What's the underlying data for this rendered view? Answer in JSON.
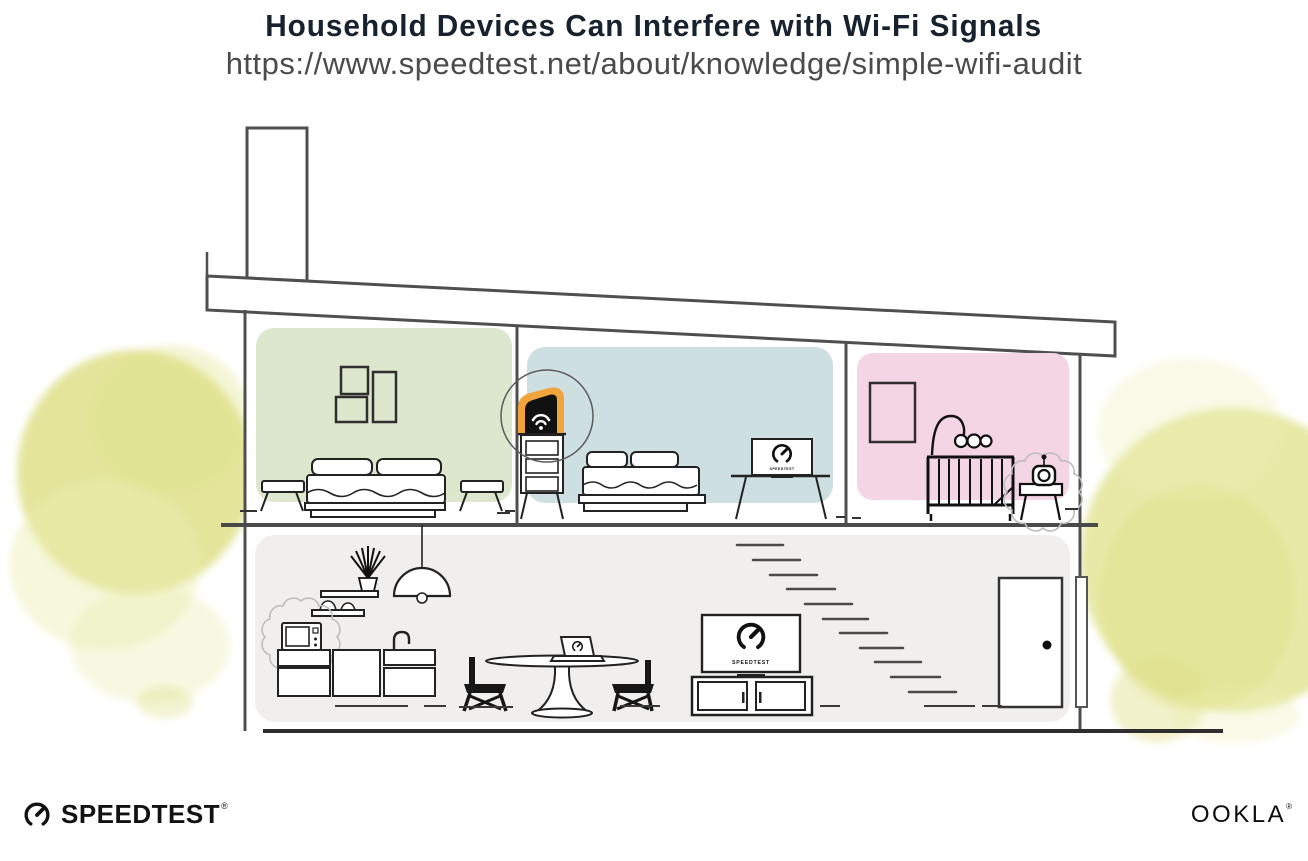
{
  "header": {
    "title": "Household Devices Can Interfere with Wi-Fi Signals",
    "url": "https://www.speedtest.net/about/knowledge/simple-wifi-audit"
  },
  "device_screens": {
    "tv_brand": "SPEEDTEST",
    "monitor_brand": "SPEEDTEST"
  },
  "footer": {
    "speedtest_wordmark": "SPEEDTEST",
    "speedtest_reg": "®",
    "ookla_wordmark": "OOKLA",
    "ookla_reg": "®"
  },
  "palette": {
    "left_bedroom_wall": "#dce7cd",
    "middle_bedroom_wall": "#cedfe2",
    "nursery_wall": "#f3d5e4",
    "living_area_floor": "#f0efed",
    "router_glow": "#f2a43c",
    "bush": "#dfe189",
    "bush_light": "#ebedaf"
  }
}
